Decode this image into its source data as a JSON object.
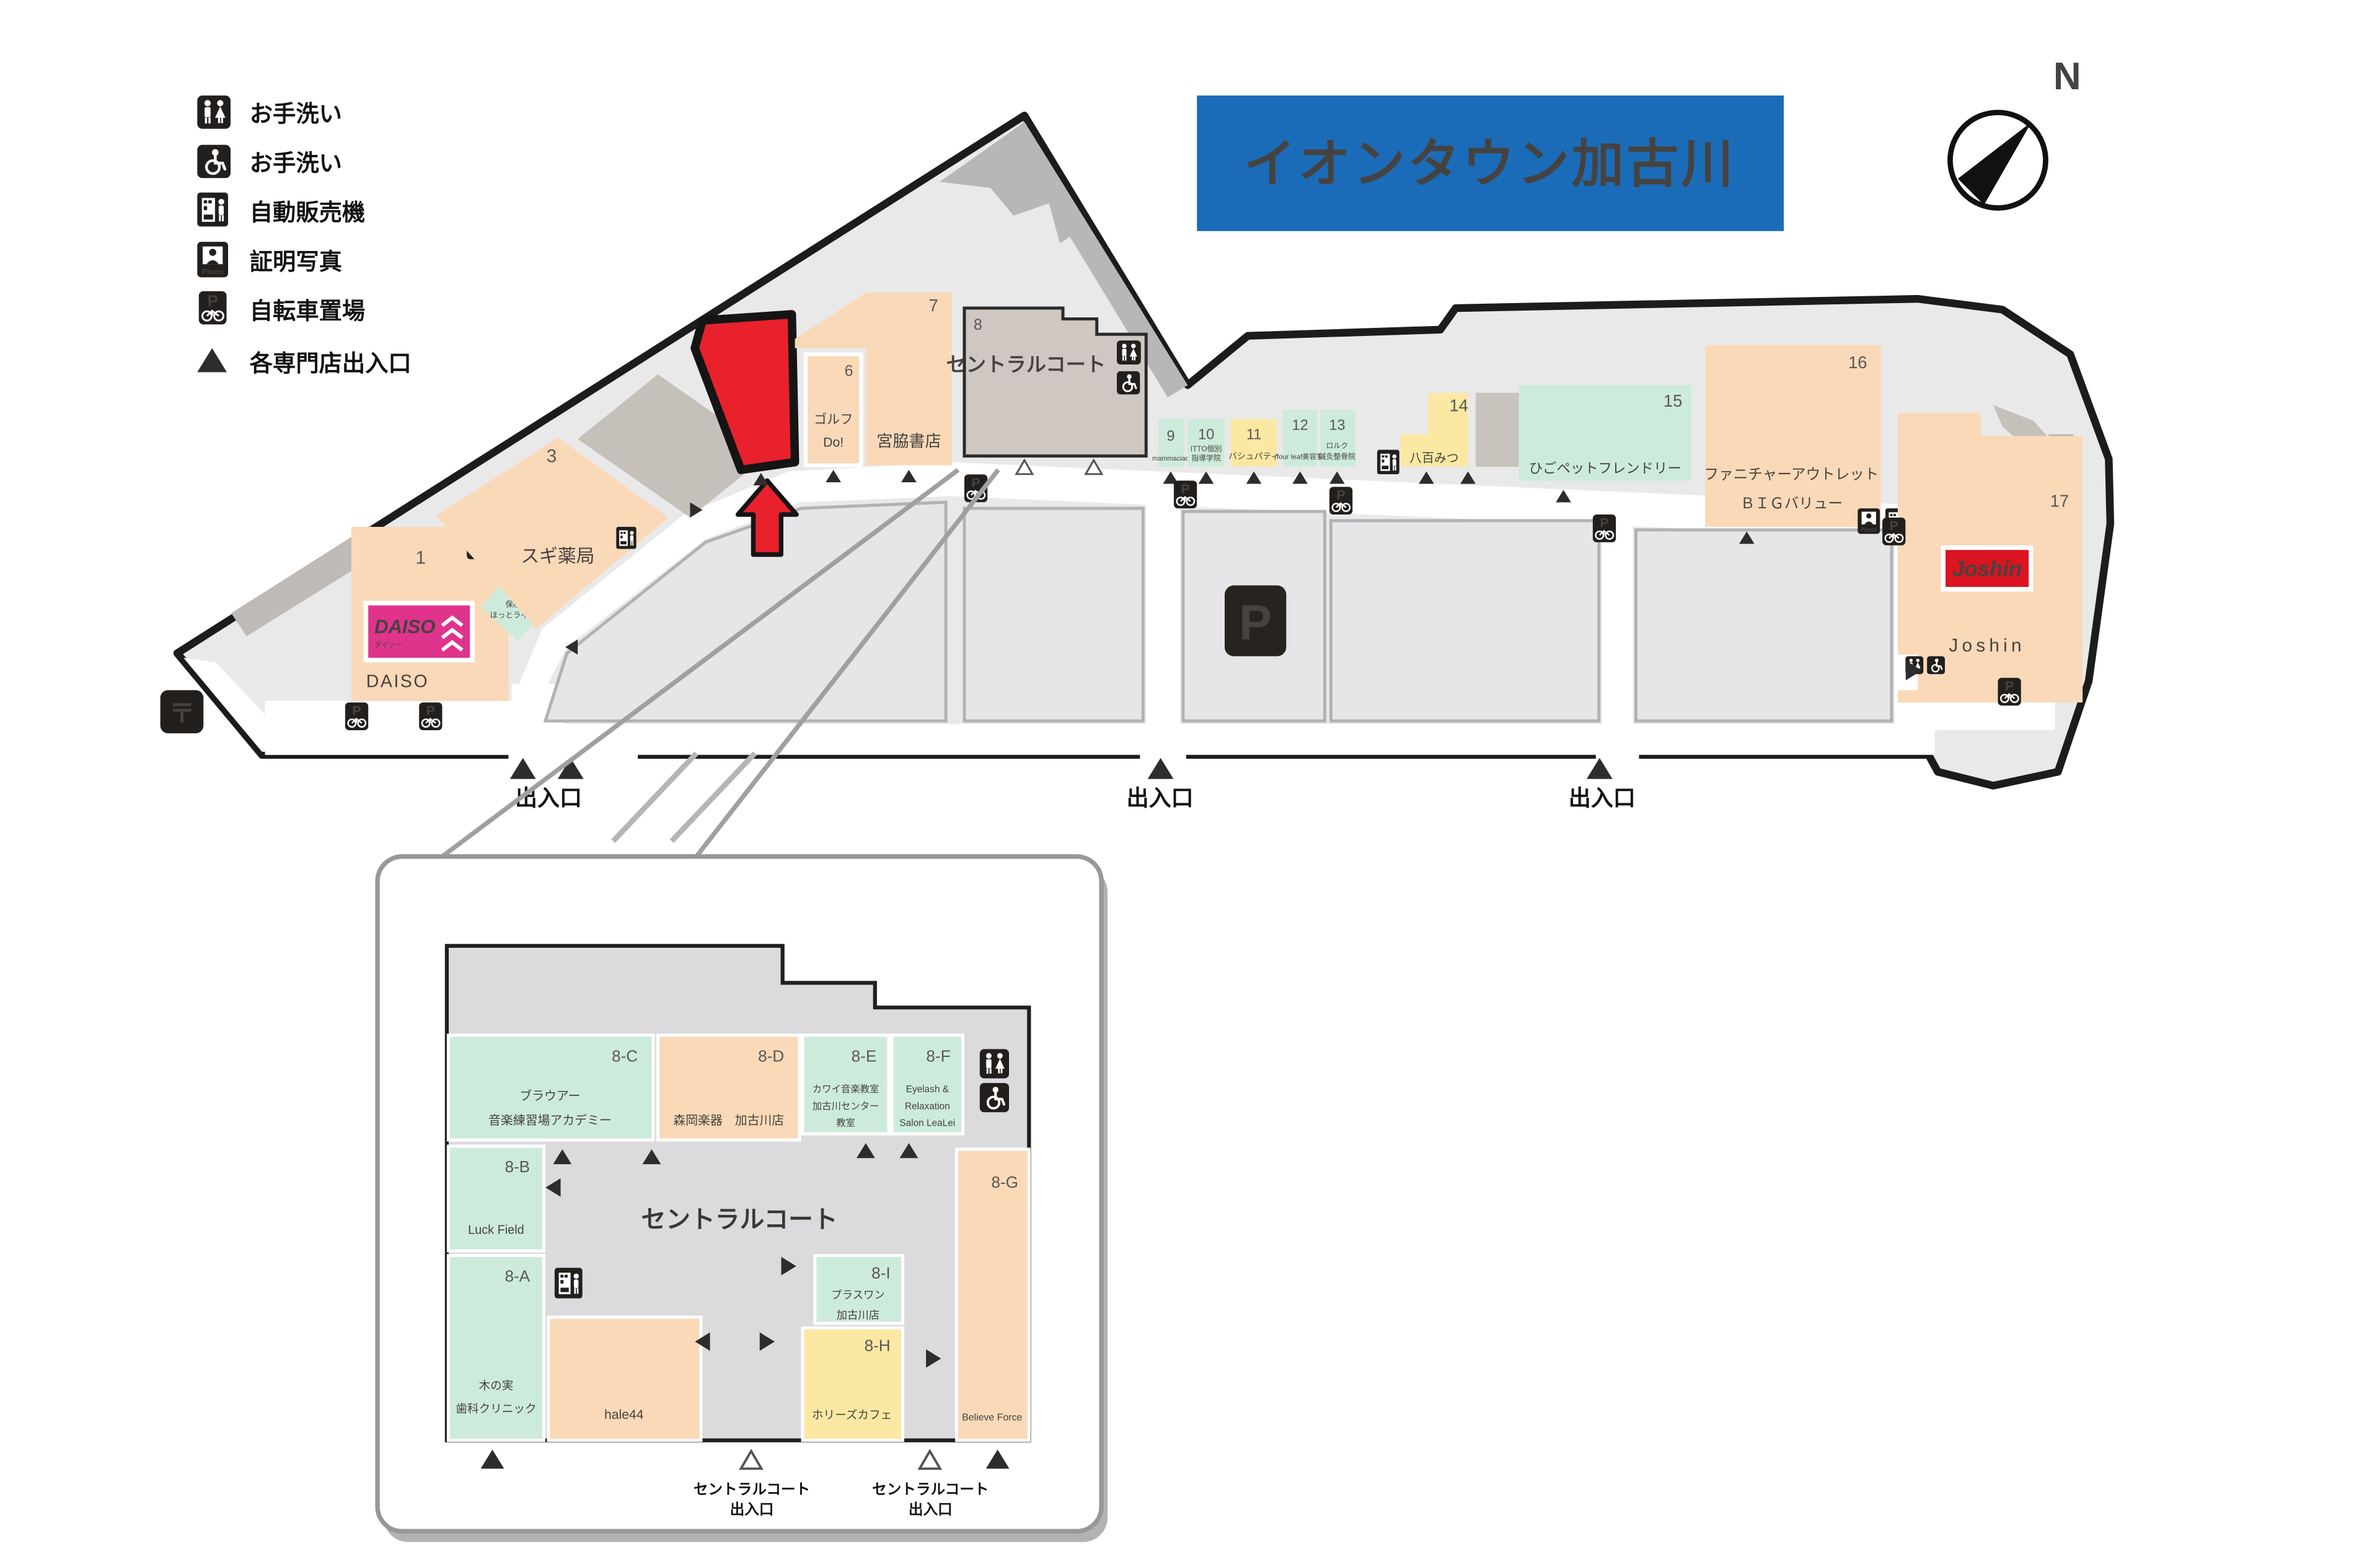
{
  "header": {
    "title": "イオンタウン加古川",
    "compass_north": "N"
  },
  "icons": {
    "parking_letter": "P",
    "bicycle_p_letter": "P",
    "photo_label": "Photo",
    "postal_mark": "〒"
  },
  "legend": {
    "items": [
      {
        "icon": "restroom-icon",
        "label": "お手洗い"
      },
      {
        "icon": "wheelchair-icon",
        "label": "お手洗い"
      },
      {
        "icon": "vending-machine-icon",
        "label": "自動販売機"
      },
      {
        "icon": "photo-booth-icon",
        "label": "証明写真"
      },
      {
        "icon": "bicycle-parking-icon",
        "label": "自転車置場"
      },
      {
        "icon": "entrance-triangle-icon",
        "label": "各専門店出入口"
      }
    ]
  },
  "main_map": {
    "exit_label": "出入口",
    "stores": {
      "s1": {
        "no": "1",
        "name": "DAISO",
        "logo": "DAISO",
        "logo_sub": "ダイソー"
      },
      "s2": {
        "no": "2",
        "line1": "保険",
        "line2": "ほっとライン"
      },
      "s3": {
        "no": "3",
        "name": "スギ薬局"
      },
      "s6": {
        "no": "6",
        "line1": "ゴルフ",
        "line2": "Do!"
      },
      "s7": {
        "no": "7",
        "name": "宮脇書店"
      },
      "s8": {
        "no": "8",
        "name": "セントラルコート"
      },
      "s9": {
        "no": "9",
        "name": "mammaciao"
      },
      "s10": {
        "no": "10",
        "line1": "ITTO個別",
        "line2": "指導学院"
      },
      "s11": {
        "no": "11",
        "name": "バシュパティ"
      },
      "s12": {
        "no": "12",
        "name": "four leaf美容室"
      },
      "s13": {
        "no": "13",
        "line1": "ロルク",
        "line2": "鍼灸整骨院"
      },
      "s14": {
        "no": "14",
        "name": "八百みつ"
      },
      "s15": {
        "no": "15",
        "name": "ひごペットフレンドリー"
      },
      "s16": {
        "no": "16",
        "line1": "ファニチャーアウトレット",
        "line2": "ＢＩＧバリュー"
      },
      "s17": {
        "no": "17",
        "logo": "Joshin",
        "name": "Joshin"
      }
    }
  },
  "inset": {
    "court_label": "セントラルコート",
    "exit_gate": {
      "line1": "セントラルコート",
      "line2": "出入口"
    },
    "stores": {
      "a": {
        "code": "8-A",
        "line1": "木の実",
        "line2": "歯科クリニック"
      },
      "b": {
        "code": "8-B",
        "name": "Luck Field"
      },
      "c": {
        "code": "8-C",
        "line1": "ブラウアー",
        "line2": "音楽練習場アカデミー"
      },
      "d": {
        "code": "8-D",
        "name": "森岡楽器　加古川店"
      },
      "e": {
        "code": "8-E",
        "line1": "カワイ音楽教室",
        "line2": "加古川センター",
        "line3": "教室"
      },
      "f": {
        "code": "8-F",
        "line1": "Eyelash &",
        "line2": "Relaxation",
        "line3": "Salon LeaLei"
      },
      "g": {
        "code": "8-G",
        "name": "Believe Force"
      },
      "h": {
        "code": "8-H",
        "name": "ホリーズカフェ"
      },
      "i": {
        "code": "8-I",
        "line1": "プラスワン",
        "line2": "加古川店"
      },
      "hale": {
        "name": "hale44"
      }
    }
  },
  "colors": {
    "banner_blue": "#1b6cb8",
    "highlight_red": "#e8212d",
    "daiso_pink": "#e0338c",
    "joshin_red": "#da1420",
    "peach": "#fad9b8",
    "mint": "#cdebdb",
    "yellow": "#fbe8a3",
    "taupe": "#cfc8c2",
    "ground": "#e9e9ea"
  }
}
